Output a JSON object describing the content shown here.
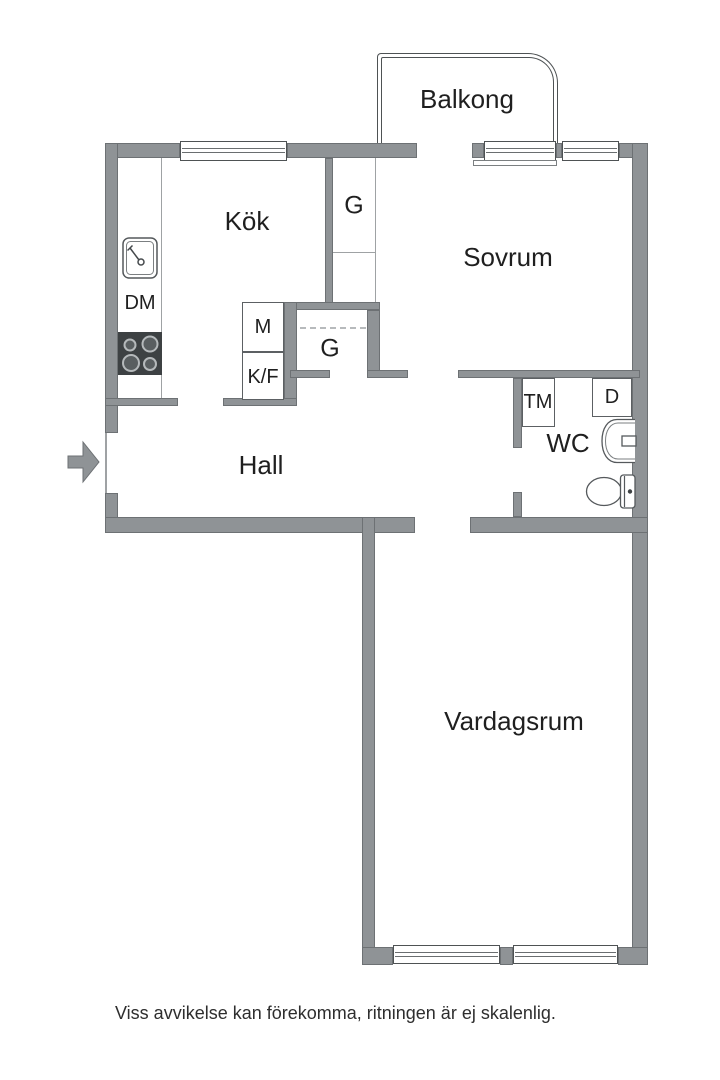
{
  "plan": {
    "rooms": {
      "balkong": "Balkong",
      "kok": "Kök",
      "sovrum": "Sovrum",
      "hall": "Hall",
      "wc": "WC",
      "vardagsrum": "Vardagsrum"
    },
    "closets": {
      "g_upper": "G",
      "g_lower": "G"
    },
    "appliances": {
      "dm": "DM",
      "m": "M",
      "kf": "K/F",
      "tm": "TM",
      "d": "D"
    },
    "colors": {
      "wall": "#8f9396",
      "wall_edge": "#6d7174",
      "fixture_line": "#55595c",
      "stove": "#3d4143",
      "text": "#1f1f1f",
      "background": "#ffffff"
    },
    "footer": {
      "disclaimer": "Viss avvikelse kan förekomma, ritningen är ej skalenlig."
    }
  }
}
